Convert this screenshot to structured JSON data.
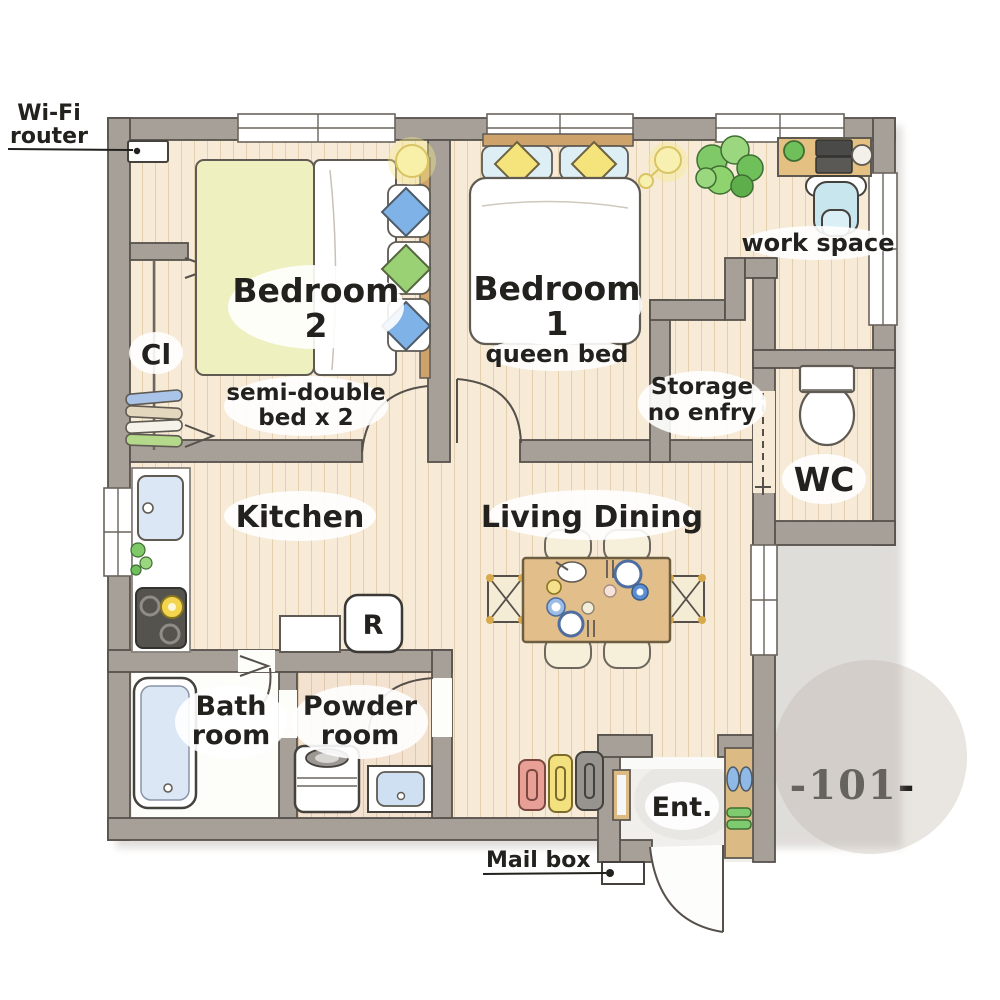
{
  "floor_plan": {
    "unit_number": "-101-",
    "callouts": {
      "wifi_line1": "Wi-Fi",
      "wifi_line2": "router",
      "mailbox": "Mail box"
    },
    "rooms": {
      "bedroom2": {
        "label": "Bedroom",
        "number": "2",
        "note1": "semi-double",
        "note2": "bed x 2"
      },
      "bedroom1": {
        "label": "Bedroom",
        "number": "1",
        "note": "queen bed"
      },
      "closet": {
        "label": "Cl"
      },
      "workspace": {
        "label": "work space"
      },
      "storage": {
        "line1": "Storage",
        "line2": "no enfry"
      },
      "wc": {
        "label": "WC"
      },
      "kitchen": {
        "label": "Kitchen"
      },
      "living_dining": {
        "label": "Living Dining"
      },
      "refrigerator": {
        "label": "R"
      },
      "bathroom": {
        "line1": "Bath",
        "line2": "room"
      },
      "powder_room": {
        "line1": "Powder",
        "line2": "room"
      },
      "entrance": {
        "label": "Ent."
      }
    },
    "palette": {
      "wall": "#a7a098",
      "wall_outline": "#57524c",
      "floor": "#f7ebd8",
      "floor_line": "#e4d0ae",
      "powder_floor": "#f4e2d1",
      "accent_blue": "#8db7e3",
      "accent_green": "#93d074",
      "accent_yellow": "#f5e47c",
      "table_wood": "#e2bf8a",
      "unit_circle": "#e9e5e1"
    }
  }
}
